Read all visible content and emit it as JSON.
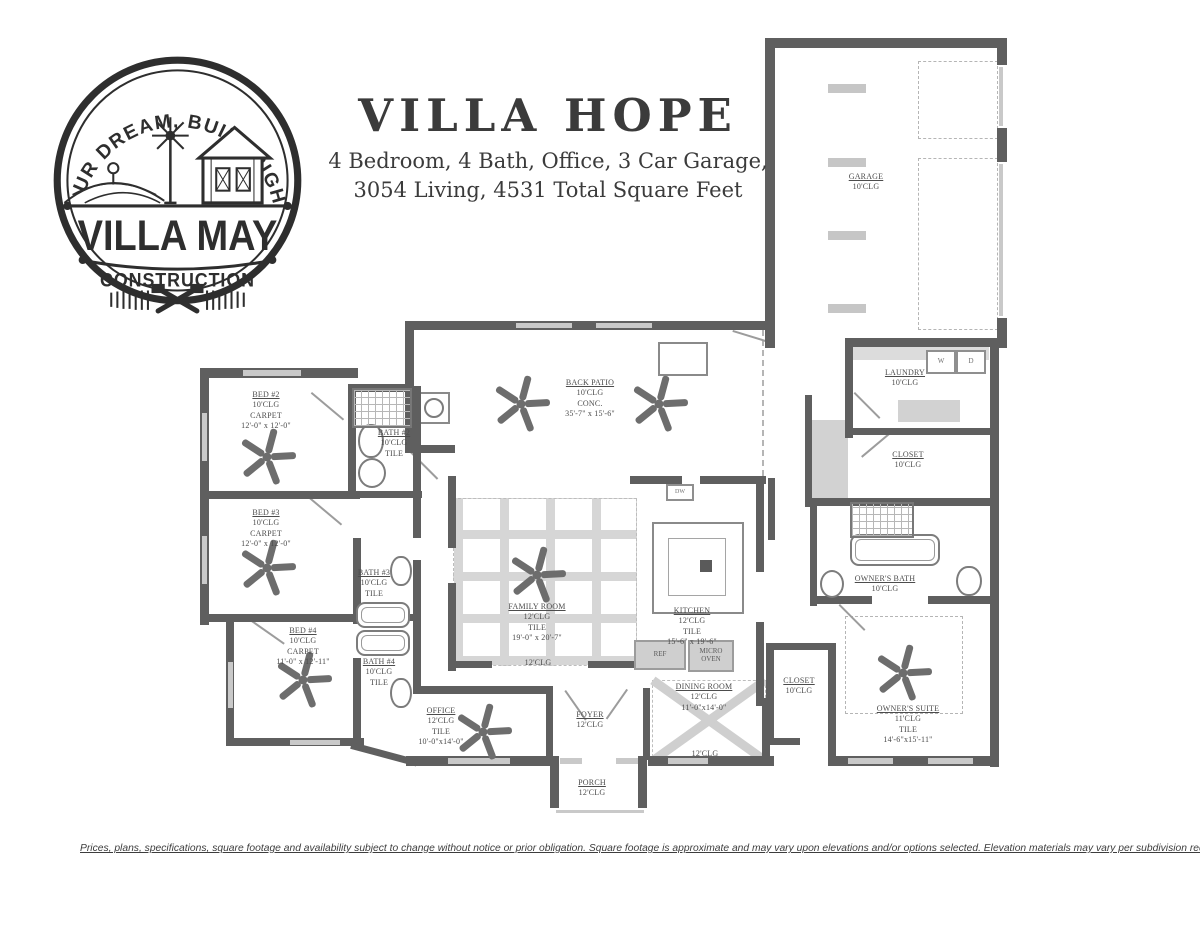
{
  "logo": {
    "tagline": "YOUR DREAM, BUILT RIGHT.",
    "brand": "VILLA MAY",
    "sub_brand": "CONSTRUCTION"
  },
  "header": {
    "title": "VILLA HOPE",
    "subtitle_line1": "4 Bedroom, 4 Bath, Office, 3 Car Garage,",
    "subtitle_line2": "3054 Living, 4531 Total Square Feet"
  },
  "plan": {
    "rooms": {
      "garage": {
        "name": "GARAGE",
        "l1": "10'CLG"
      },
      "laundry": {
        "name": "LAUNDRY",
        "l1": "10'CLG"
      },
      "laundry_closet": {
        "name": "CLOSET",
        "l1": "10'CLG"
      },
      "back_patio": {
        "name": "BACK PATIO",
        "l1": "10'CLG",
        "l2": "CONC.",
        "l3": "35'-7\" x 15'-6\""
      },
      "bed2": {
        "name": "BED #2",
        "l1": "10'CLG",
        "l2": "CARPET",
        "l3": "12'-0\" x 12'-0\""
      },
      "bath2": {
        "name": "BATH #2",
        "l1": "10'CLG",
        "l2": "TILE"
      },
      "bed3": {
        "name": "BED #3",
        "l1": "10'CLG",
        "l2": "CARPET",
        "l3": "12'-0\" x 12'-0\""
      },
      "bath3": {
        "name": "BATH #3",
        "l1": "10'CLG",
        "l2": "TILE"
      },
      "bed4": {
        "name": "BED #4",
        "l1": "10'CLG",
        "l2": "CARPET",
        "l3": "11'-0\" x 12'-11\""
      },
      "bath4": {
        "name": "BATH #4",
        "l1": "10'CLG",
        "l2": "TILE"
      },
      "family_room": {
        "name": "FAMILY ROOM",
        "l1": "12'CLG",
        "l2": "TILE",
        "l3": "19'-0\" x 20'-7\""
      },
      "family_hall": {
        "l1": "12'CLG"
      },
      "kitchen": {
        "name": "KITCHEN",
        "l1": "12'CLG",
        "l2": "TILE",
        "l3": "15'-6\" x 19'-6\""
      },
      "dining": {
        "name": "DINING ROOM",
        "l1": "12'CLG",
        "l2": "11'-0\"x14'-0\""
      },
      "dining_hall": {
        "l1": "12'CLG"
      },
      "owners_bath": {
        "name": "OWNER'S BATH",
        "l1": "10'CLG"
      },
      "owners_closet": {
        "name": "CLOSET",
        "l1": "10'CLG"
      },
      "owners_suite": {
        "name": "OWNER'S SUITE",
        "l1": "11'CLG",
        "l2": "TILE",
        "l3": "14'-6\"x15'-11\""
      },
      "office": {
        "name": "OFFICE",
        "l1": "12'CLG",
        "l2": "TILE",
        "l3": "10'-0\"x14'-0\""
      },
      "foyer": {
        "name": "FOYER",
        "l1": "12'CLG"
      },
      "porch": {
        "name": "PORCH",
        "l1": "12'CLG"
      }
    },
    "appliances": {
      "washer": "W",
      "dryer": "D",
      "ref": "REF",
      "micro_l1": "MICRO",
      "micro_l2": "OVEN",
      "dw": "DW"
    }
  },
  "footer": {
    "disclaimer": "Prices, plans, specifications, square footage and availability subject to change without notice or prior obligation. Square footage is approximate and may vary upon elevations and/or options selected. Elevation materials may vary per subdivision requirement."
  },
  "colors": {
    "wall": "#5f5f5f",
    "window_marker": "#c9c9c9",
    "light_gray": "#cfcfcf",
    "text": "#4c4c4c",
    "ink": "#2e2e2e"
  }
}
